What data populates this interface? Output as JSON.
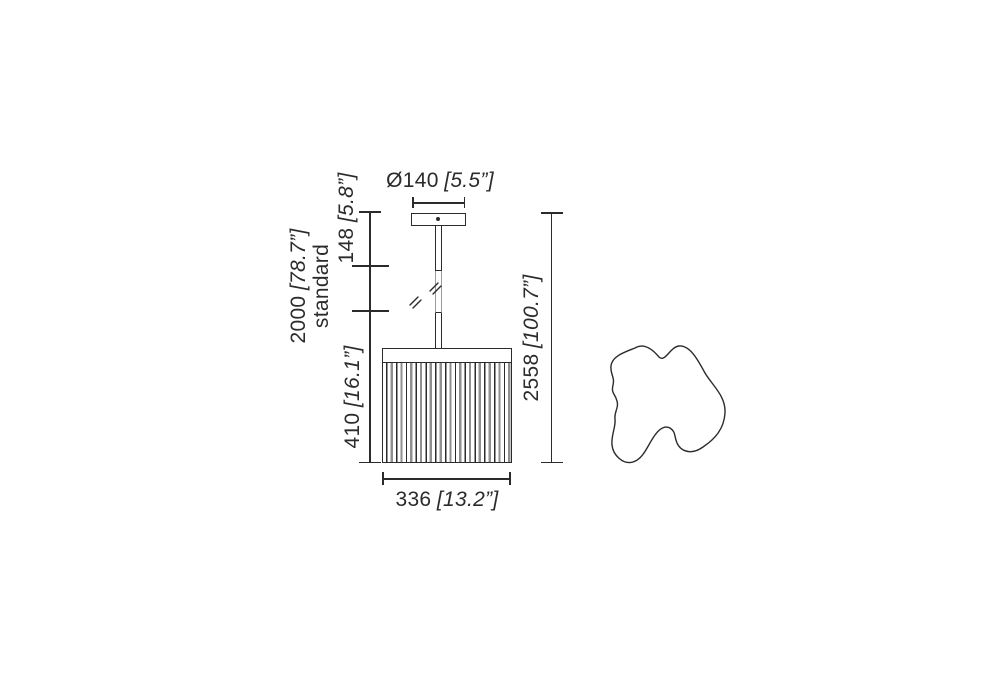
{
  "drawing": {
    "labels": {
      "canopy_diameter": {
        "value": "Ø140",
        "inches": "[5.5”]"
      },
      "canopy_drop": {
        "value": "148",
        "inches": "[5.8”]"
      },
      "suspension": {
        "value": "2000",
        "inches": "[78.7”]",
        "note": "standard"
      },
      "shade_height": {
        "value": "410",
        "inches": "[16.1”]"
      },
      "overall_height": {
        "value": "2558",
        "inches": "[100.7”]"
      },
      "shade_width": {
        "value": "336",
        "inches": "[13.2”]"
      }
    },
    "colors": {
      "line": "#2b2b2b",
      "pleat_gray": "#8f8f8f",
      "break_gray": "#9a9a9a",
      "background": "#ffffff"
    }
  }
}
